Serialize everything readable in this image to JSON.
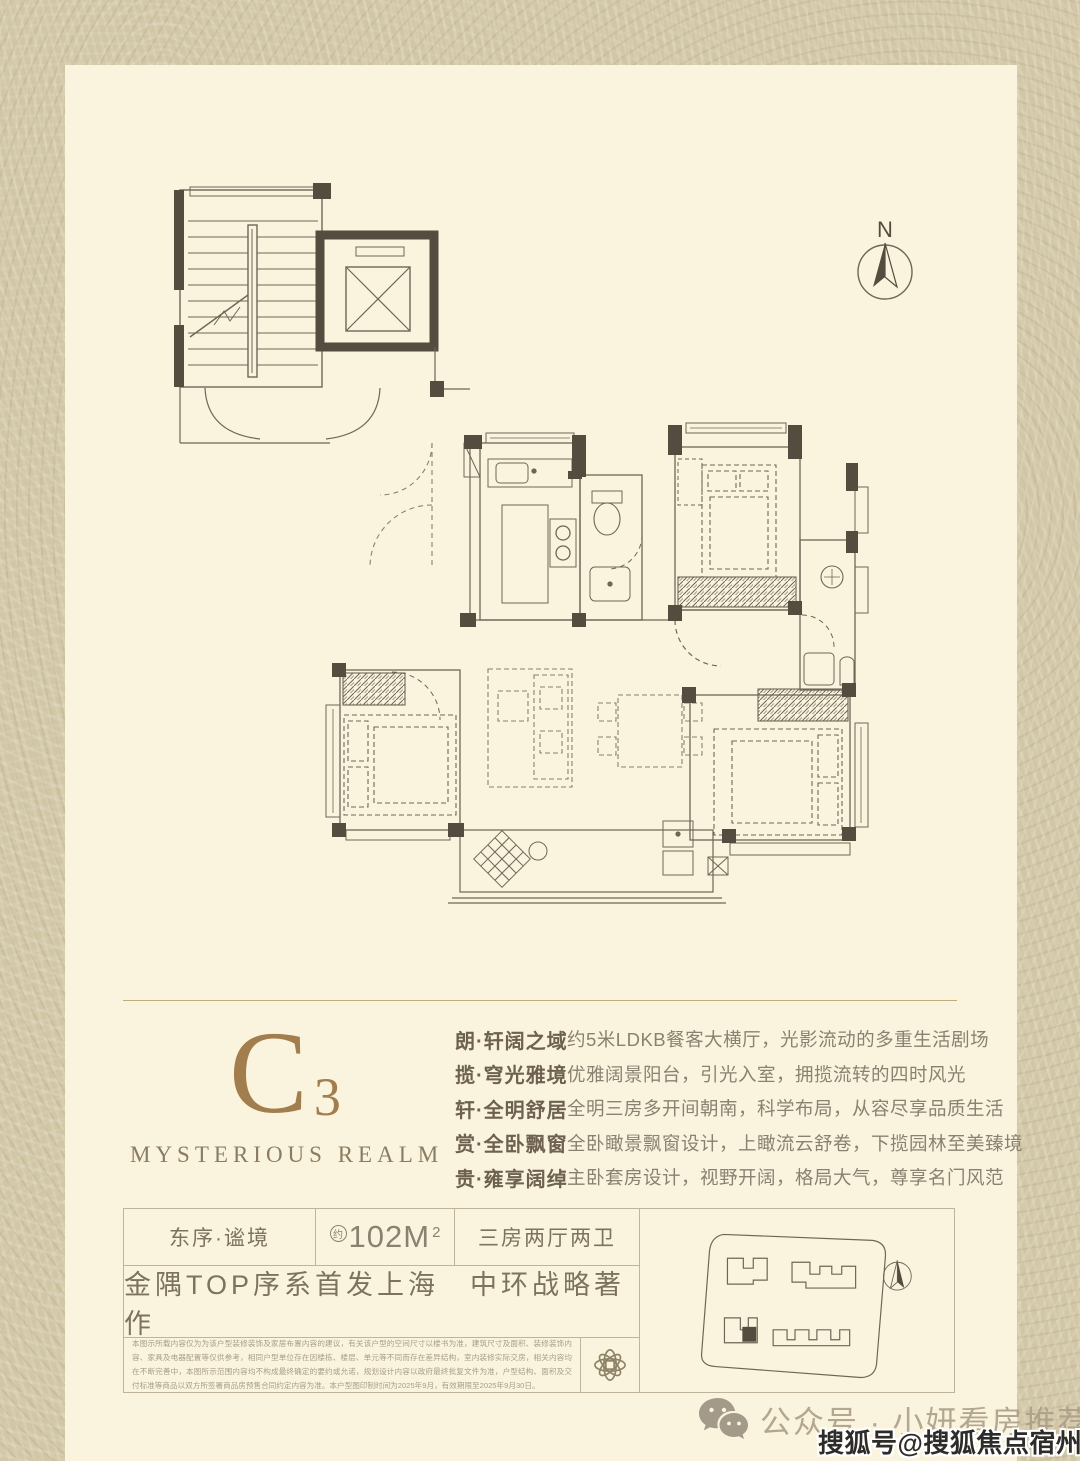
{
  "colors": {
    "texture_bg": "#d5caa9",
    "panel_bg": "#faf4de",
    "plan_line": "#6e6657",
    "plan_wall_dark": "#544c3e",
    "accent_gold": "#a27d4d",
    "table_border": "#bfb49a"
  },
  "compass": {
    "label": "N"
  },
  "brand": {
    "letter": "C",
    "number": "3",
    "subtitle": "MYSTERIOUS REALM"
  },
  "features": [
    {
      "label": "朗·轩阔之域",
      "text": "约5米LDKB餐客大横厅，光影流动的多重生活剧场"
    },
    {
      "label": "揽·穹光雅境",
      "text": "优雅阔景阳台，引光入室，拥揽流转的四时风光"
    },
    {
      "label": "轩·全明舒居",
      "text": "全明三房多开间朝南，科学布局，从容尽享品质生活"
    },
    {
      "label": "赏·全卧飘窗",
      "text": "全卧瞰景飘窗设计，上瞰流云舒卷，下揽园林至美臻境"
    },
    {
      "label": "贵·雍享阔绰",
      "text": "主卧套房设计，视野开阔，格局大气，尊享名门风范"
    }
  ],
  "info": {
    "name": "东序·谧境",
    "area_circle": "约",
    "area_value": "102M",
    "area_sup": "2",
    "layout": "三房两厅两卫",
    "tagline": "金隅TOP序系首发上海　中环战略著作"
  },
  "disclaimer": {
    "text": "本图示所载内容仅为为该户型装修装饰及家居布置内容的建议，有关该户型的空间尺寸以楼书为准，建筑尺寸及面积、装修装饰内容、家具及电器配置等仅供参考，相同户型单位存在因楼栋、楼层、单元等不同而存在差异结构，室内装修实际交房，相关内容均在不断完善中，本图所示范围内容均不构成最终确定的要约或允诺，规划设计内容以政府最终批复文件为准，户型结构、面积及交付标准等商品以双方所签署商品房预售合同约定内容为准。本户型图印制时间为2025年9月，有效期限至2025年9月30日。"
  },
  "watermarks": {
    "wechat": "公众号 · 小妍看房推荐",
    "sohu": "搜狐号@搜狐焦点宿州站"
  }
}
